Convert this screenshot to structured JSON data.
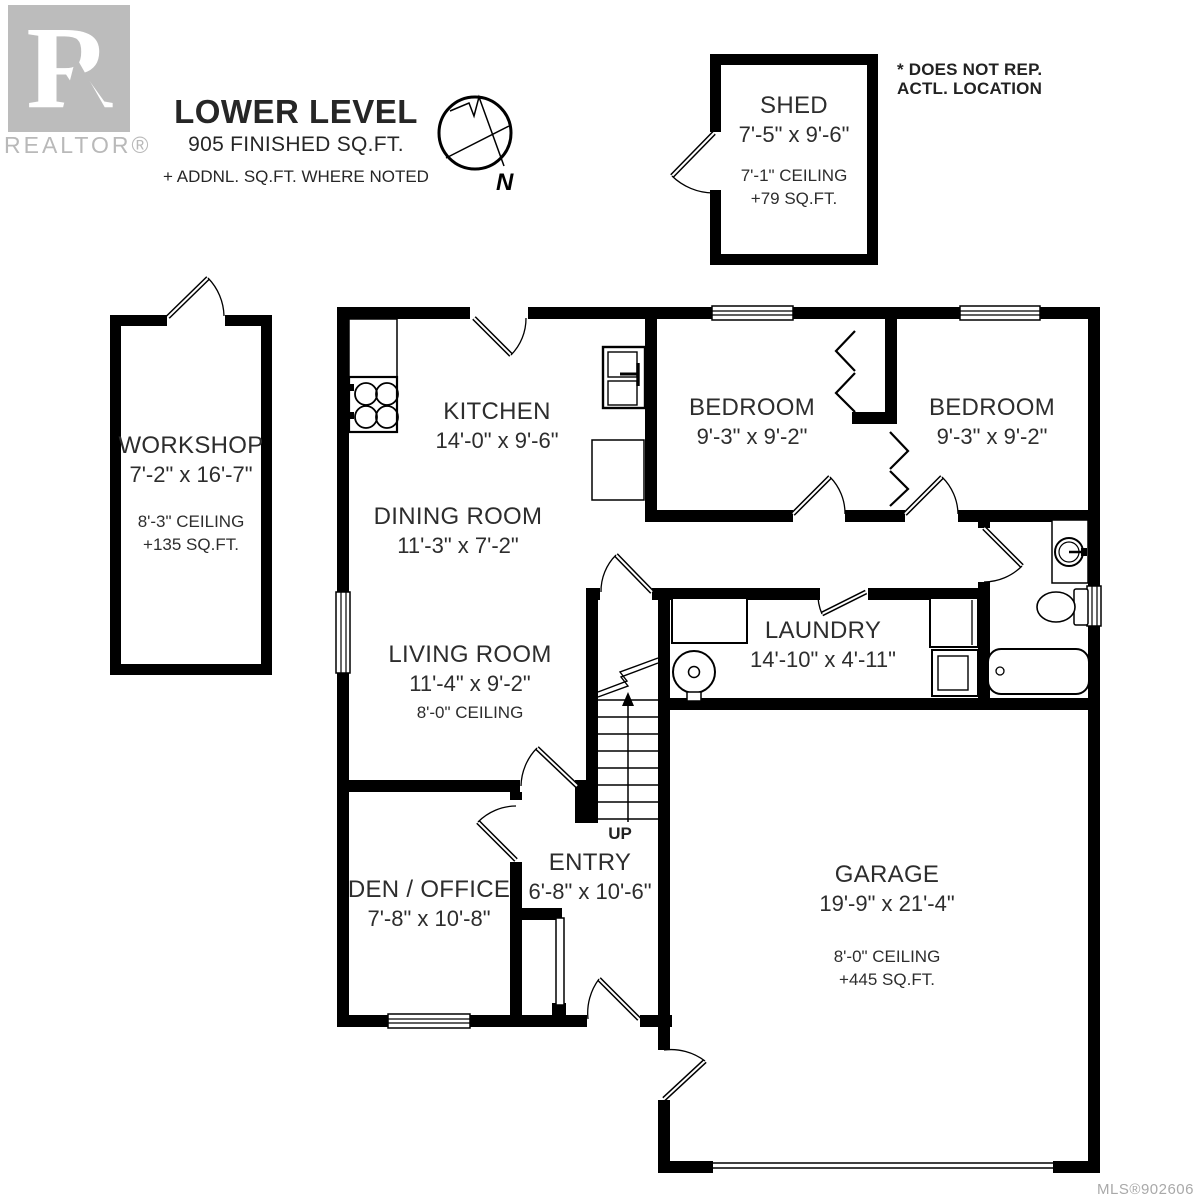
{
  "branding": {
    "logo_letter": "R",
    "logo_text": "REALTOR®"
  },
  "title": {
    "heading": "LOWER LEVEL",
    "subheading": "905 FINISHED SQ.FT.",
    "note": "+ ADDNL. SQ.FT. WHERE NOTED"
  },
  "compass": {
    "label": "N"
  },
  "disclaimer": {
    "line1": "* DOES NOT REP.",
    "line2": "ACTL. LOCATION"
  },
  "stairs": {
    "label": "UP"
  },
  "rooms": {
    "shed": {
      "name": "SHED",
      "dims": "7'-5\" x 9'-6\"",
      "ceiling": "7'-1\" CEILING",
      "area": "+79 SQ.FT."
    },
    "workshop": {
      "name": "WORKSHOP",
      "dims": "7'-2\" x 16'-7\"",
      "ceiling": "8'-3\" CEILING",
      "area": "+135 SQ.FT."
    },
    "kitchen": {
      "name": "KITCHEN",
      "dims": "14'-0\" x 9'-6\""
    },
    "dining_room": {
      "name": "DINING ROOM",
      "dims": "11'-3\" x 7'-2\""
    },
    "living_room": {
      "name": "LIVING ROOM",
      "dims": "11'-4\" x 9'-2\"",
      "ceiling": "8'-0\" CEILING"
    },
    "den_office": {
      "name": "DEN / OFFICE",
      "dims": "7'-8\" x 10'-8\""
    },
    "entry": {
      "name": "ENTRY",
      "dims": "6'-8\" x 10'-6\""
    },
    "bedroom_left": {
      "name": "BEDROOM",
      "dims": "9'-3\" x 9'-2\""
    },
    "bedroom_right": {
      "name": "BEDROOM",
      "dims": "9'-3\" x 9'-2\""
    },
    "laundry": {
      "name": "LAUNDRY",
      "dims": "14'-10\" x 4'-11\""
    },
    "garage": {
      "name": "GARAGE",
      "dims": "19'-9\" x 21'-4\"",
      "ceiling": "8'-0\" CEILING",
      "area": "+445 SQ.FT."
    }
  },
  "footer": {
    "mls": "MLS®902606"
  },
  "colors": {
    "wall": "#000000",
    "text": "#2d2d2d",
    "muted": "#b9b9b9"
  }
}
